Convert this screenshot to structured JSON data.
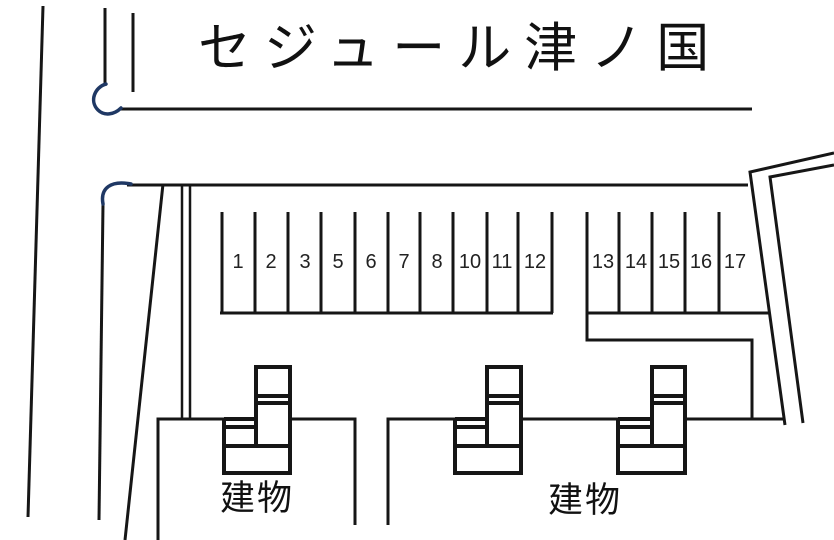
{
  "title": "セジュール津ノ国",
  "parking": {
    "left_block": [
      "1",
      "2",
      "3",
      "5",
      "6",
      "7",
      "8",
      "10",
      "11",
      "12"
    ],
    "right_block": [
      "13",
      "14",
      "15",
      "16",
      "17"
    ]
  },
  "buildings": [
    {
      "label": "建物"
    },
    {
      "label": "建物"
    }
  ],
  "colors": {
    "line": "#161616",
    "curve_accent": "#1f3864",
    "number_text": "#222222"
  }
}
